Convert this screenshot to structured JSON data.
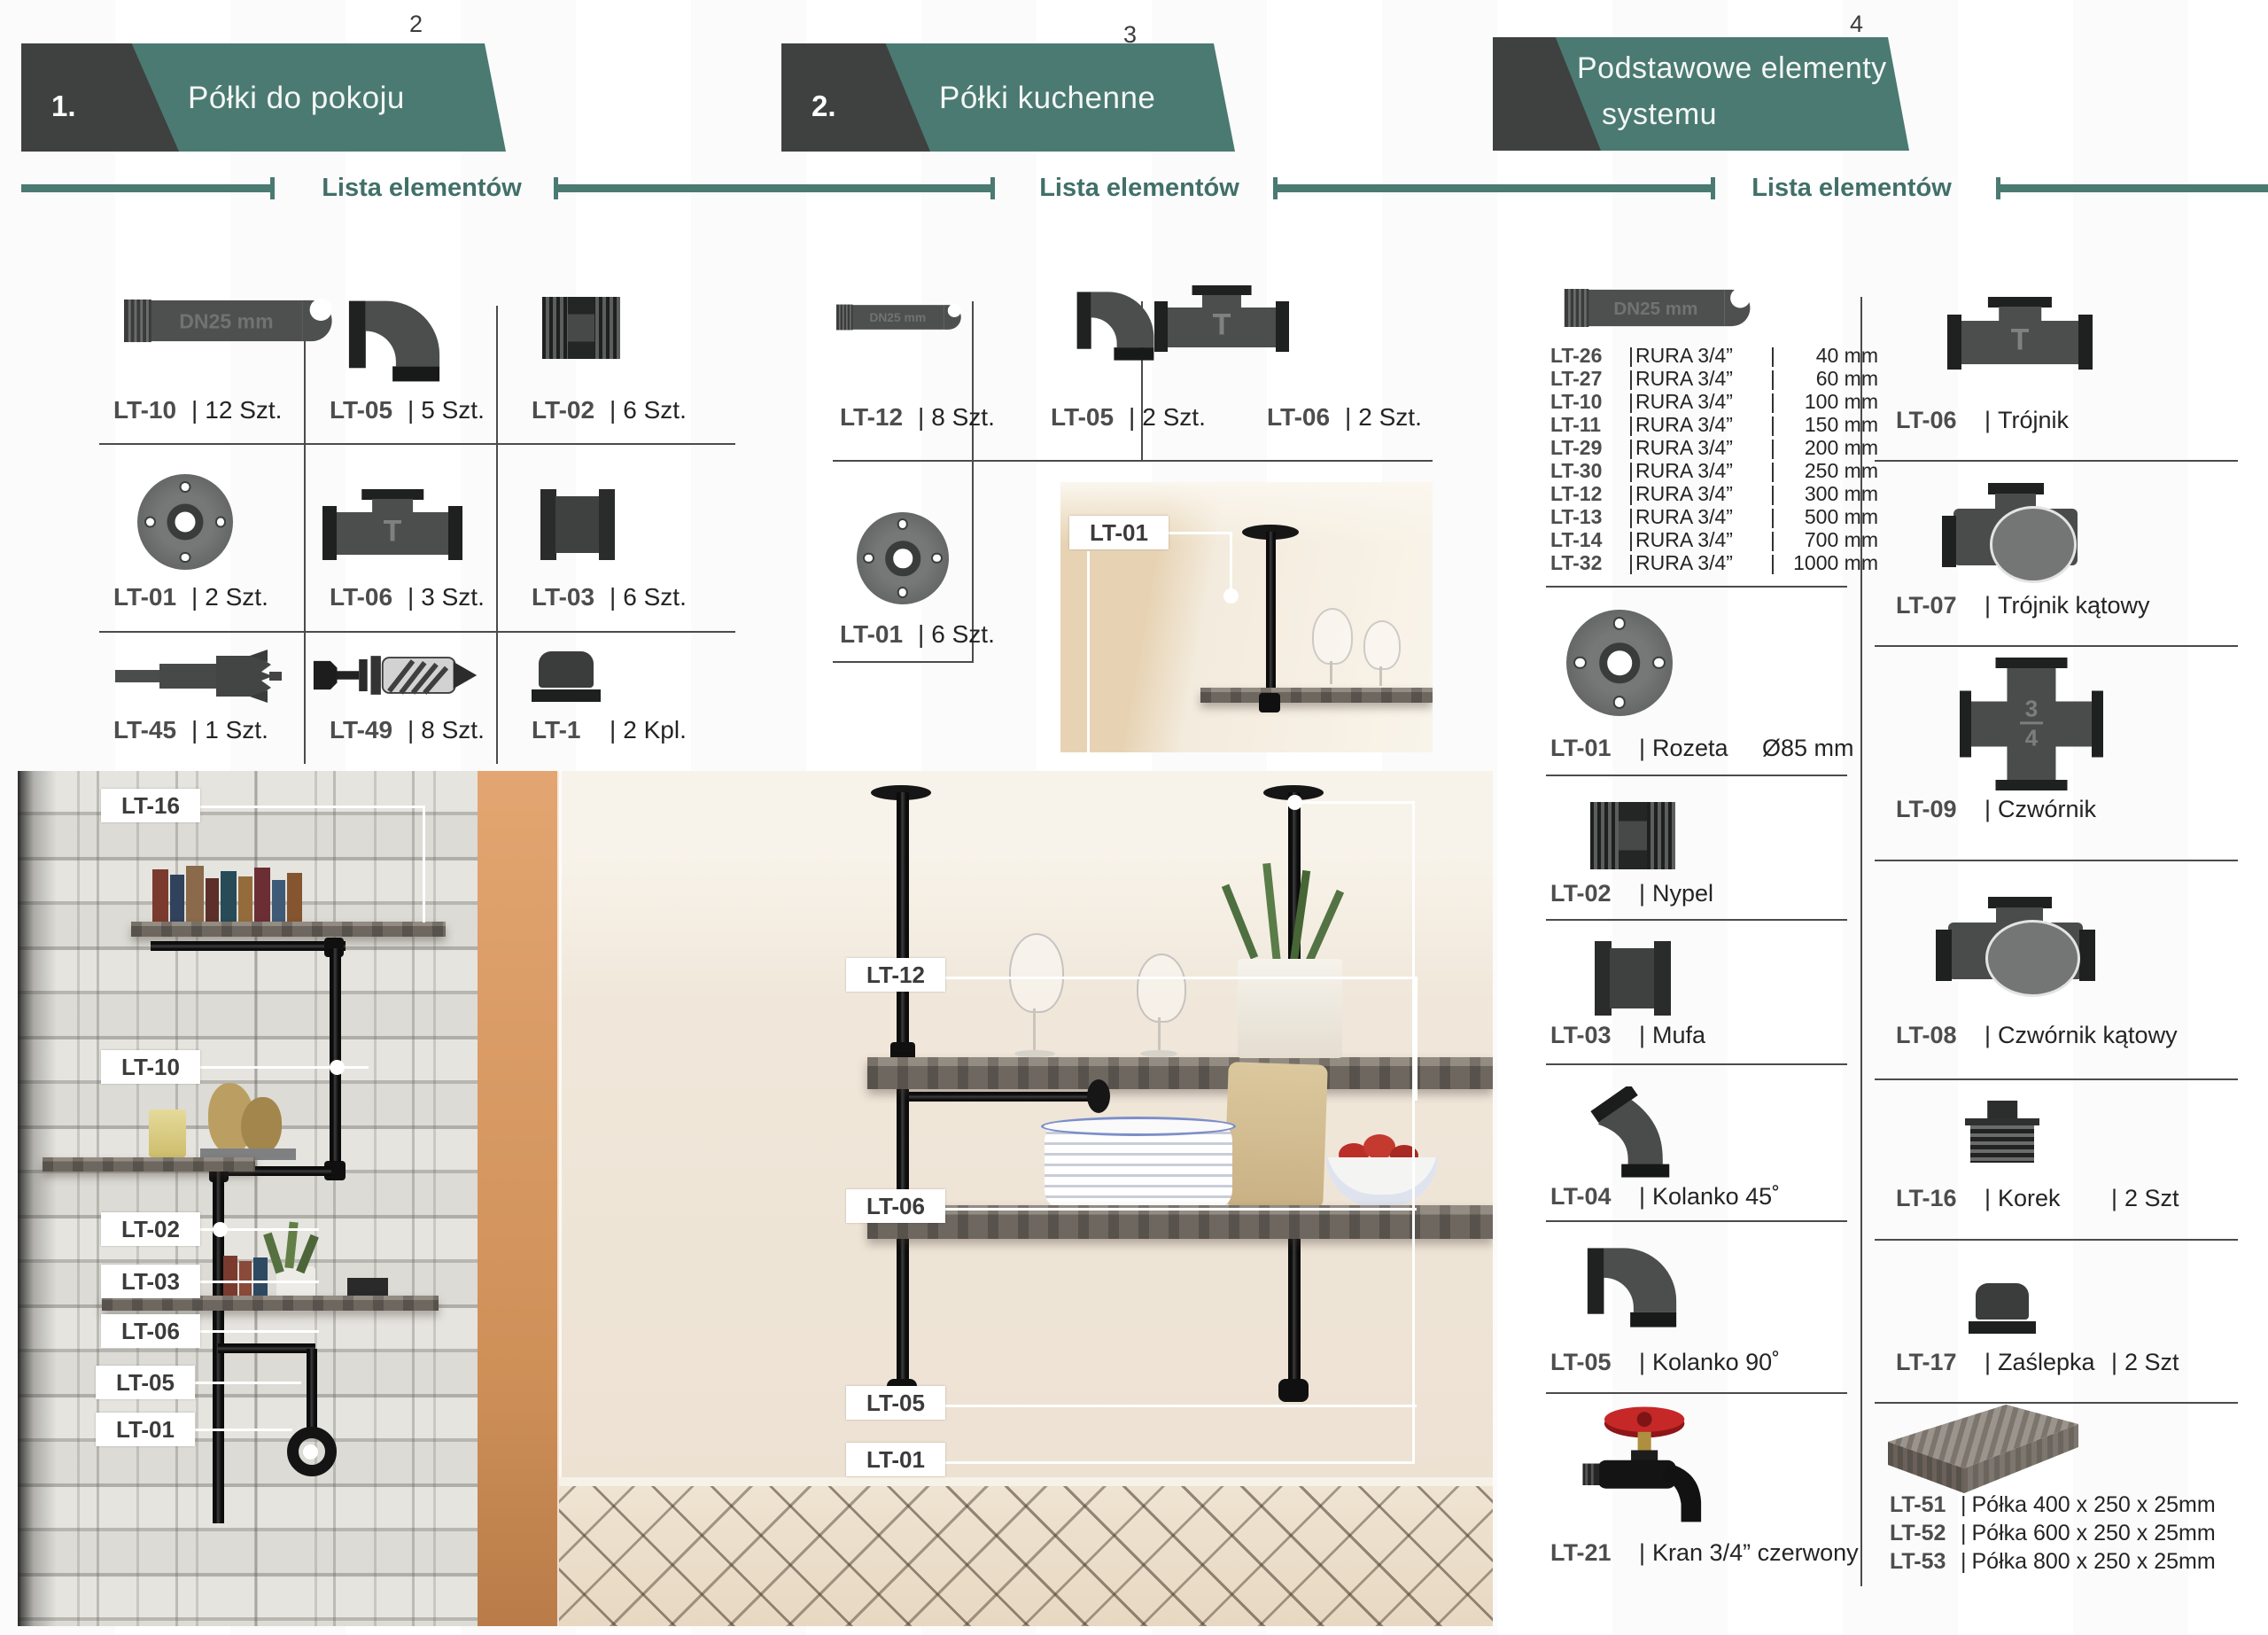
{
  "sep": "|",
  "pipe_marking": "DN25 mm",
  "list_label": "Lista elementów",
  "colors": {
    "teal": "#4A7A71",
    "dark": "#3F4040"
  },
  "icon_text": {
    "tee": "T",
    "cross_num": "3",
    "cross_den": "4"
  },
  "headers": [
    {
      "number": "1.",
      "title": "Półki do pokoju",
      "page": "2"
    },
    {
      "number": "2.",
      "title": "Półki kuchenne",
      "page": "3"
    },
    {
      "number": "",
      "title_line1": "Podstawowe elementy",
      "title_line2": "systemu",
      "page": "4"
    }
  ],
  "section1": {
    "parts": [
      {
        "code": "LT-10",
        "qty": "12 Szt."
      },
      {
        "code": "LT-05",
        "qty": "5 Szt."
      },
      {
        "code": "LT-02",
        "qty": "6 Szt."
      },
      {
        "code": "LT-01",
        "qty": "2 Szt."
      },
      {
        "code": "LT-06",
        "qty": "3 Szt."
      },
      {
        "code": "LT-03",
        "qty": "6 Szt."
      },
      {
        "code": "LT-45",
        "qty": "1 Szt."
      },
      {
        "code": "LT-49",
        "qty": "8 Szt."
      },
      {
        "code": "LT-1",
        "qty": "2 Kpl."
      }
    ],
    "photo_labels": [
      "LT-16",
      "LT-10",
      "LT-02",
      "LT-03",
      "LT-06",
      "LT-05",
      "LT-01"
    ]
  },
  "section2": {
    "parts": [
      {
        "code": "LT-12",
        "qty": "8 Szt."
      },
      {
        "code": "LT-05",
        "qty": "2 Szt."
      },
      {
        "code": "LT-06",
        "qty": "2 Szt."
      },
      {
        "code": "LT-01",
        "qty": "6 Szt."
      }
    ],
    "inset_label": "LT-01",
    "photo_labels": [
      "LT-12",
      "LT-06",
      "LT-05",
      "LT-01"
    ]
  },
  "section3": {
    "rura": [
      {
        "code": "LT-26",
        "desc": "RURA 3/4”",
        "len": "40 mm"
      },
      {
        "code": "LT-27",
        "desc": "RURA 3/4”",
        "len": "60 mm"
      },
      {
        "code": "LT-10",
        "desc": "RURA 3/4”",
        "len": "100 mm"
      },
      {
        "code": "LT-11",
        "desc": "RURA 3/4”",
        "len": "150 mm"
      },
      {
        "code": "LT-29",
        "desc": "RURA 3/4”",
        "len": "200 mm"
      },
      {
        "code": "LT-30",
        "desc": "RURA 3/4”",
        "len": "250 mm"
      },
      {
        "code": "LT-12",
        "desc": "RURA 3/4”",
        "len": "300 mm"
      },
      {
        "code": "LT-13",
        "desc": "RURA 3/4”",
        "len": "500 mm"
      },
      {
        "code": "LT-14",
        "desc": "RURA 3/4”",
        "len": "700 mm"
      },
      {
        "code": "LT-32",
        "desc": "RURA 3/4”",
        "len": "1000 mm"
      }
    ],
    "left_parts": [
      {
        "code": "LT-01",
        "name": "Rozeta",
        "extra": "Ø85 mm"
      },
      {
        "code": "LT-02",
        "name": "Nypel"
      },
      {
        "code": "LT-03",
        "name": "Mufa"
      },
      {
        "code": "LT-04",
        "name": "Kolanko 45˚"
      },
      {
        "code": "LT-05",
        "name": "Kolanko 90˚"
      },
      {
        "code": "LT-21",
        "name": "Kran 3/4” czerwony"
      }
    ],
    "right_parts": [
      {
        "code": "LT-06",
        "name": "Trójnik"
      },
      {
        "code": "LT-07",
        "name": "Trójnik kątowy"
      },
      {
        "code": "LT-09",
        "name": "Czwórnik"
      },
      {
        "code": "LT-08",
        "name": "Czwórnik kątowy"
      },
      {
        "code": "LT-16",
        "name": "Korek",
        "qty": "2 Szt"
      },
      {
        "code": "LT-17",
        "name": "Zaślepka",
        "qty": "2 Szt"
      }
    ],
    "shelf_parts": [
      {
        "code": "LT-51",
        "name": "Półka 400 x 250 x 25mm"
      },
      {
        "code": "LT-52",
        "name": "Półka 600 x 250 x 25mm"
      },
      {
        "code": "LT-53",
        "name": "Półka 800 x 250 x 25mm"
      }
    ]
  }
}
